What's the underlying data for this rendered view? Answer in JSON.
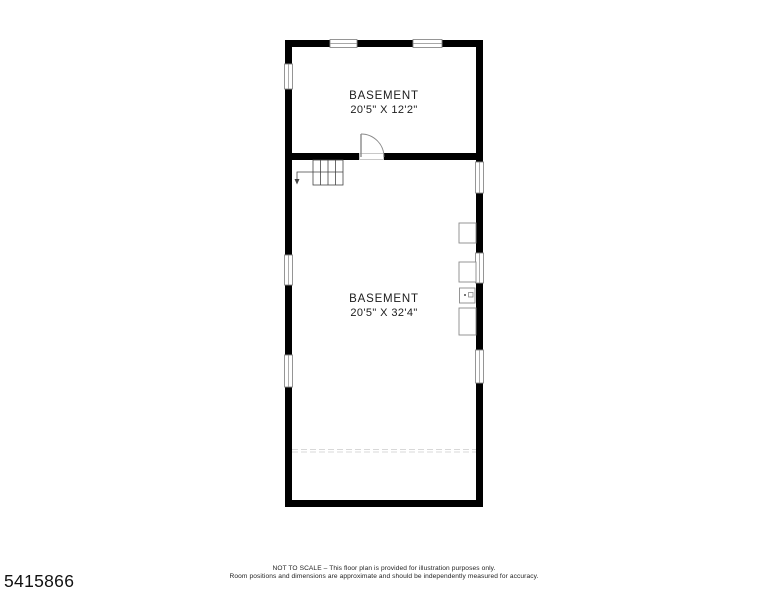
{
  "page": {
    "background": "#ffffff",
    "type": "floor-plan"
  },
  "floor_plan": {
    "rooms": [
      {
        "name": "BASEMENT",
        "dimensions": "20'5\" X 12'2\""
      },
      {
        "name": "BASEMENT",
        "dimensions": "20'5\" X 32'4\""
      }
    ],
    "symbols": [
      {
        "name": "stairs",
        "treads": 4,
        "direction": "arrow-down-left"
      },
      {
        "name": "door-swing",
        "location": "divider-wall"
      },
      {
        "name": "window",
        "count": 8
      },
      {
        "name": "utility-fixture-box",
        "count": 4
      },
      {
        "name": "dashed-reference-line",
        "count": 1
      }
    ],
    "colors": {
      "wall": "#000000",
      "window_outline": "#8a8a8a",
      "fixture_outline": "#8a8a8a",
      "stair_line": "#444444",
      "dashed_line": "#d8d8d8",
      "text": "#1c1c1c"
    }
  },
  "footer": {
    "listing_id": "5415866",
    "disclaimer_line1": "NOT TO SCALE – This floor plan is provided for illustration purposes only.",
    "disclaimer_line2": "Room positions and dimensions are approximate and should be independently measured for accuracy."
  }
}
